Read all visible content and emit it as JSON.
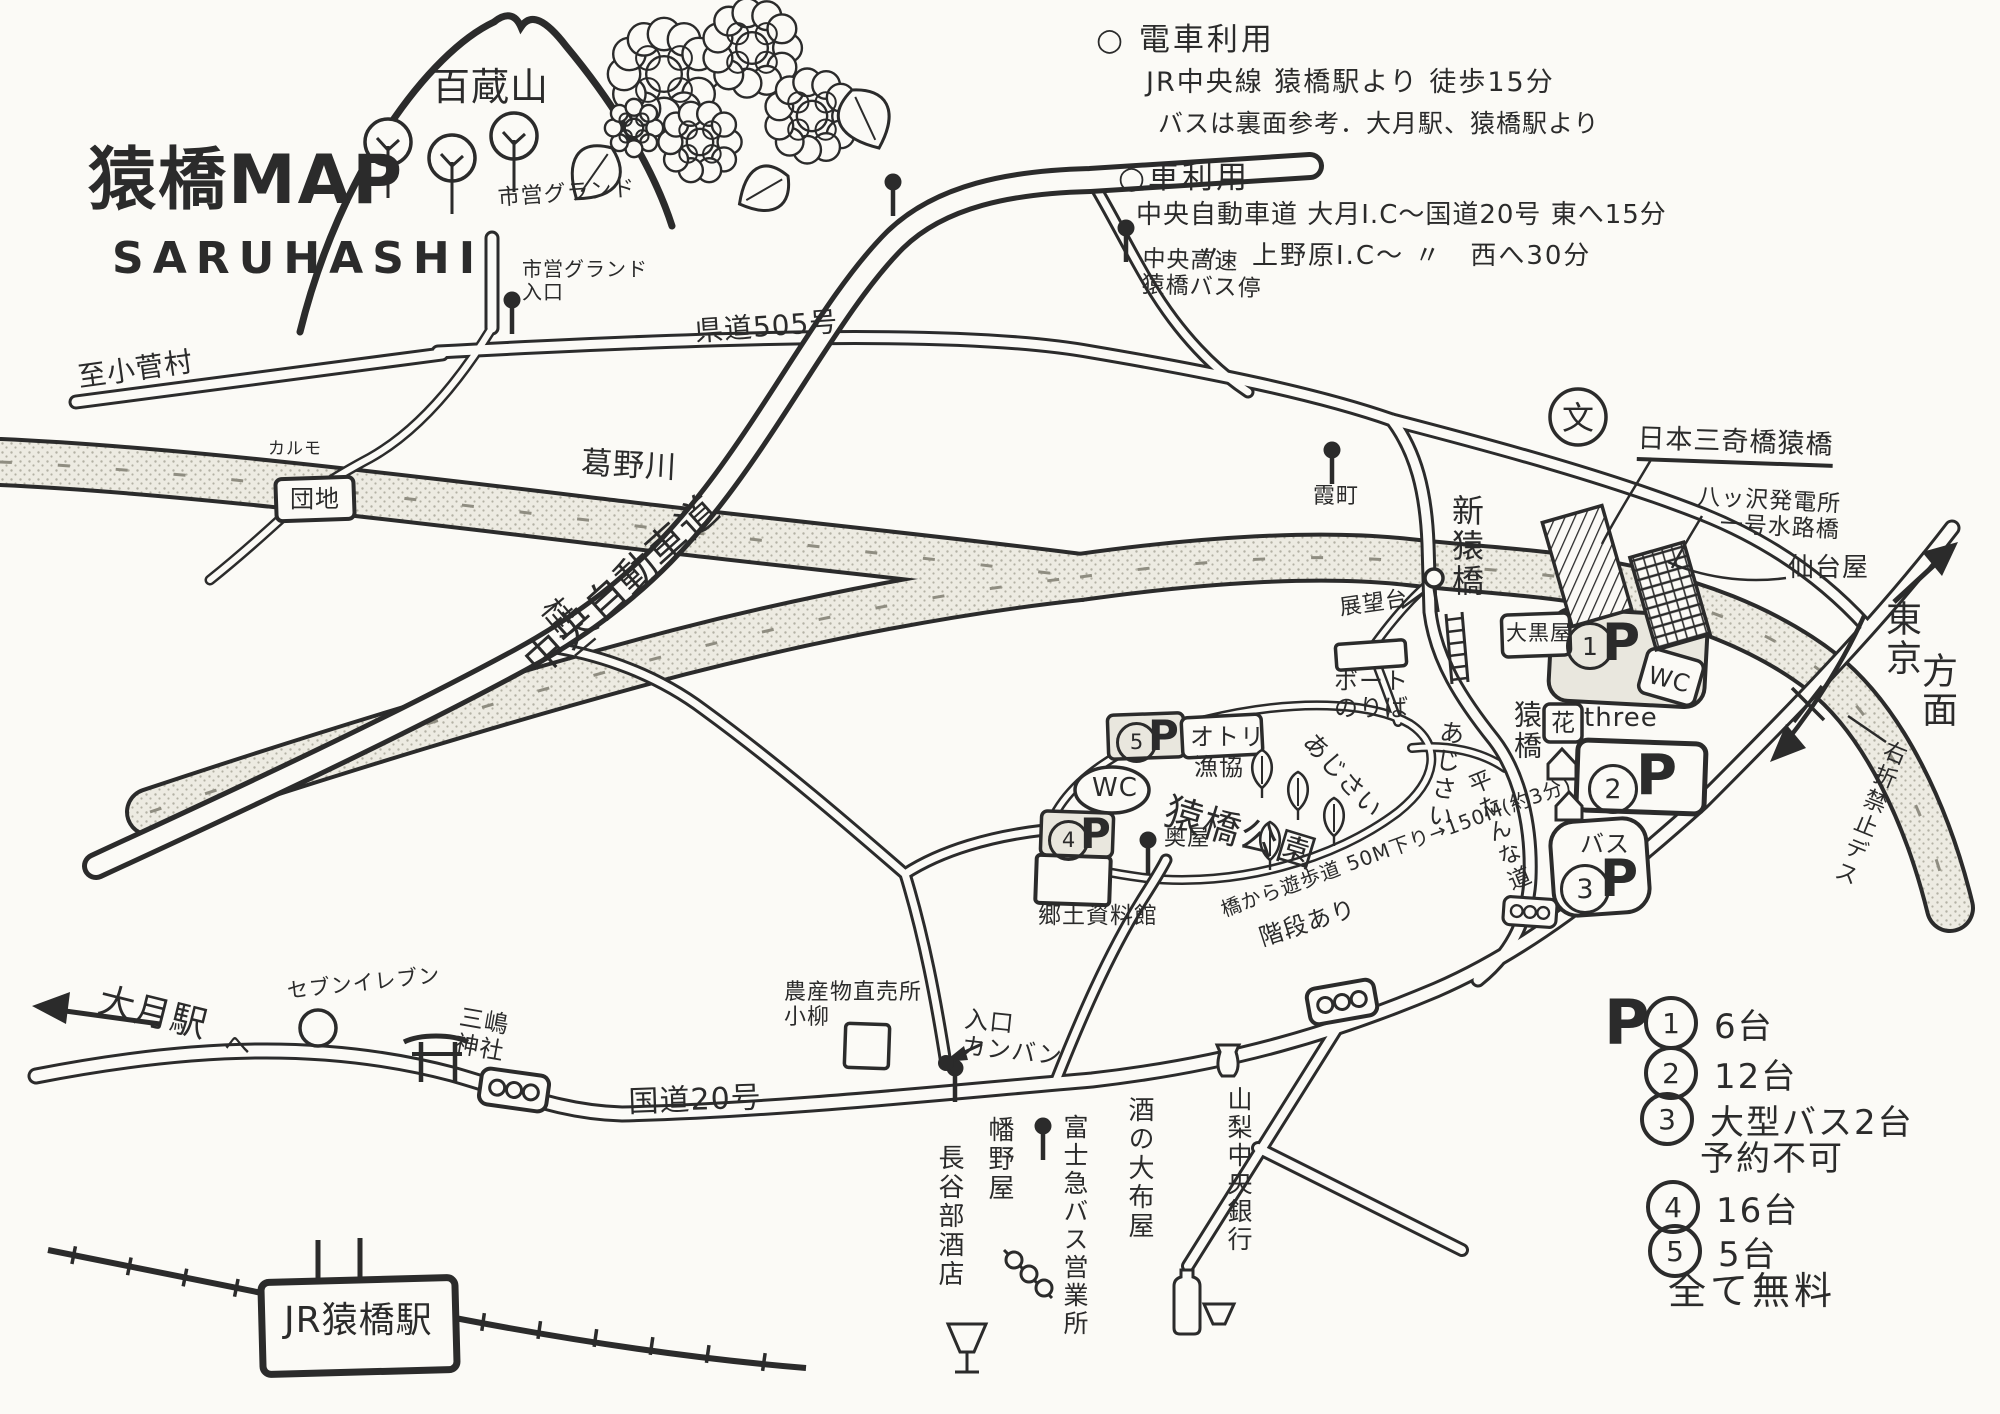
{
  "title": {
    "main": "猿橋MAP",
    "sub": "SARUHASHI"
  },
  "notes": {
    "train_title": "○ 電車利用",
    "train_line1": "JR中央線 猿橋駅より 徒歩15分",
    "train_line2": "バスは裏面参考．大月駅、猿橋駅より",
    "car_title": "○車利用",
    "car_line1": "中央自動車道 大月I.C〜国道20号 東へ15分",
    "car_line2": "〃　上野原I.C〜 〃　西へ30分"
  },
  "legend": {
    "symbol": "P",
    "items": [
      {
        "num": "1",
        "text": "6台"
      },
      {
        "num": "2",
        "text": "12台"
      },
      {
        "num": "3",
        "text": "大型バス2台",
        "note": "予約不可"
      },
      {
        "num": "4",
        "text": "16台"
      },
      {
        "num": "5",
        "text": "5台"
      }
    ],
    "footer": "全て無料"
  },
  "map_labels": [
    {
      "id": "mt-momokura",
      "text": "百蔵山",
      "x": 432,
      "y": 66,
      "size": 38
    },
    {
      "id": "shiei-ground",
      "text": "市営グランド",
      "x": 497,
      "y": 186,
      "size": 22,
      "rot": -4
    },
    {
      "id": "shiei-ground-entrance",
      "text": "市営グランド\n入口",
      "x": 522,
      "y": 258,
      "size": 20
    },
    {
      "id": "chuo-kosoku-bus-stop",
      "text": "中央高速\n猿橋バス停",
      "x": 1143,
      "y": 246,
      "size": 23,
      "rot": 2
    },
    {
      "id": "kendo-505",
      "text": "県道505号",
      "x": 694,
      "y": 316,
      "size": 28,
      "rot": -4
    },
    {
      "id": "to-kosuge-mura",
      "text": "至小菅村",
      "x": 76,
      "y": 362,
      "size": 28,
      "rot": -8
    },
    {
      "id": "karumo",
      "text": "カルモ",
      "x": 268,
      "y": 440,
      "size": 17
    },
    {
      "id": "danchi",
      "text": "団地",
      "x": 290,
      "y": 486,
      "size": 24
    },
    {
      "id": "chuo-expressway",
      "text": "中央自動車道",
      "x": 516,
      "y": 652,
      "size": 40,
      "rot": -42
    },
    {
      "id": "katsuno-river",
      "text": "葛野川",
      "x": 582,
      "y": 446,
      "size": 31,
      "rot": 3
    },
    {
      "id": "katsura-river",
      "text": "桂川",
      "x": 560,
      "y": 592,
      "size": 31,
      "rot": 50
    },
    {
      "id": "kasumi-cho",
      "text": "霞町",
      "x": 1313,
      "y": 484,
      "size": 22
    },
    {
      "id": "shin-saruhashi",
      "text": "新猿橋",
      "x": 1450,
      "y": 494,
      "size": 32,
      "vertical": true
    },
    {
      "id": "school-mark",
      "text": "文",
      "x": 1562,
      "y": 400,
      "size": 32
    },
    {
      "id": "nihon-sankyo-saruhashi",
      "text": "日本三奇橋猿橋",
      "x": 1638,
      "y": 424,
      "size": 27,
      "rot": 2,
      "underline": true
    },
    {
      "id": "yatsuzawa-power",
      "text": "八ッ沢発電所\n　一号水路橋",
      "x": 1698,
      "y": 484,
      "size": 23,
      "rot": 3
    },
    {
      "id": "sendai-ya",
      "text": "仙台屋",
      "x": 1788,
      "y": 554,
      "size": 26
    },
    {
      "id": "tokyo",
      "text": "東京",
      "x": 1882,
      "y": 600,
      "size": 36,
      "vertical": true
    },
    {
      "id": "homen",
      "text": "方面",
      "x": 1918,
      "y": 652,
      "size": 36,
      "vertical": true
    },
    {
      "id": "no-right-turn",
      "text": "右折禁止デス",
      "x": 1886,
      "y": 736,
      "size": 23,
      "vertical": true,
      "rot": 22
    },
    {
      "id": "tenbodai",
      "text": "展望台",
      "x": 1338,
      "y": 596,
      "size": 22,
      "rot": -8
    },
    {
      "id": "boat-noriba",
      "text": "ボート\nのりば",
      "x": 1334,
      "y": 668,
      "size": 24
    },
    {
      "id": "otori",
      "text": "オトリ",
      "x": 1190,
      "y": 724,
      "size": 24
    },
    {
      "id": "gyokyo",
      "text": "漁協",
      "x": 1194,
      "y": 754,
      "size": 24
    },
    {
      "id": "wc-park",
      "text": "WC",
      "x": 1092,
      "y": 774,
      "size": 26
    },
    {
      "id": "saruhashi-park",
      "text": "猿橋公園",
      "x": 1172,
      "y": 790,
      "size": 38,
      "rot": 17
    },
    {
      "id": "ajisai-1",
      "text": "あじさい",
      "x": 1318,
      "y": 728,
      "size": 25,
      "rot": 48
    },
    {
      "id": "ajisai-2",
      "text": "あじさい",
      "x": 1440,
      "y": 718,
      "size": 25,
      "vertical": true,
      "rot": 8
    },
    {
      "id": "flat-road",
      "text": "平たんな道",
      "x": 1462,
      "y": 776,
      "size": 23,
      "vertical": true,
      "rot": -22
    },
    {
      "id": "promenade-note",
      "text": "橋から遊歩道 50M下り→150M(約3分)",
      "x": 1218,
      "y": 900,
      "size": 20,
      "rot": -20
    },
    {
      "id": "stairs-note",
      "text": "階段あり",
      "x": 1256,
      "y": 926,
      "size": 24,
      "rot": -18
    },
    {
      "id": "kyodo-museum",
      "text": "郷土資料館",
      "x": 1038,
      "y": 903,
      "size": 23
    },
    {
      "id": "saruhashi-bridge",
      "text": "猿橋",
      "x": 1512,
      "y": 700,
      "size": 28,
      "vertical": true
    },
    {
      "id": "hana",
      "text": "花",
      "x": 1551,
      "y": 710,
      "size": 24
    },
    {
      "id": "three",
      "text": "three",
      "x": 1584,
      "y": 704,
      "size": 26
    },
    {
      "id": "daikoku-ya",
      "text": "大黒屋",
      "x": 1506,
      "y": 622,
      "size": 21
    },
    {
      "id": "p1-num",
      "circle": true,
      "text": "1",
      "x": 1566,
      "y": 622,
      "size": 32
    },
    {
      "id": "p1-p",
      "text": "P",
      "x": 1602,
      "y": 614,
      "size": 52,
      "bold": true
    },
    {
      "id": "wc-east",
      "text": "WC",
      "x": 1652,
      "y": 662,
      "size": 24,
      "rot": 14
    },
    {
      "id": "p2-num",
      "circle": true,
      "text": "2",
      "x": 1588,
      "y": 764,
      "size": 34
    },
    {
      "id": "p2-p",
      "text": "P",
      "x": 1636,
      "y": 744,
      "size": 56,
      "bold": true
    },
    {
      "id": "bus-p3",
      "text": "バス",
      "x": 1580,
      "y": 831,
      "size": 24
    },
    {
      "id": "p3-num",
      "circle": true,
      "text": "3",
      "x": 1560,
      "y": 864,
      "size": 34
    },
    {
      "id": "p3-p",
      "text": "P",
      "x": 1600,
      "y": 850,
      "size": 52,
      "bold": true
    },
    {
      "id": "p4-num",
      "circle": true,
      "text": "4",
      "x": 1048,
      "y": 820,
      "size": 27
    },
    {
      "id": "p4-p",
      "text": "P",
      "x": 1080,
      "y": 810,
      "size": 42,
      "bold": true
    },
    {
      "id": "p5-num",
      "circle": true,
      "text": "5",
      "x": 1116,
      "y": 722,
      "size": 27
    },
    {
      "id": "p5-p",
      "text": "P",
      "x": 1148,
      "y": 712,
      "size": 42,
      "bold": true
    },
    {
      "id": "oku-ya",
      "text": "奥屋",
      "x": 1164,
      "y": 826,
      "size": 22
    },
    {
      "id": "to-otsuki-station",
      "text": "大月駅",
      "x": 104,
      "y": 980,
      "size": 36,
      "rot": 14
    },
    {
      "id": "to-otsuki-he",
      "text": "へ",
      "x": 224,
      "y": 1032,
      "size": 26
    },
    {
      "id": "seven-eleven",
      "text": "セブンイレブン",
      "x": 286,
      "y": 980,
      "size": 21,
      "rot": -6
    },
    {
      "id": "mishima-shrine",
      "text": "三嶋\n神社",
      "x": 462,
      "y": 1004,
      "size": 24,
      "rot": 10
    },
    {
      "id": "route-20",
      "text": "国道20号",
      "x": 628,
      "y": 1086,
      "size": 30,
      "rot": -2
    },
    {
      "id": "farm-stand",
      "text": "農産物直売所\n小柳",
      "x": 784,
      "y": 980,
      "size": 22
    },
    {
      "id": "entrance-signboard",
      "text": "入口\nカンバン",
      "x": 966,
      "y": 1006,
      "size": 24,
      "rot": 6
    },
    {
      "id": "hatano-ya",
      "text": "幡野屋",
      "x": 986,
      "y": 1116,
      "size": 26,
      "vertical": true
    },
    {
      "id": "hasebe-saketen",
      "text": "長谷部酒店",
      "x": 936,
      "y": 1144,
      "size": 26,
      "vertical": true
    },
    {
      "id": "fujikyu-bus-office",
      "text": "富士急バス営業所",
      "x": 1062,
      "y": 1114,
      "size": 25,
      "vertical": true
    },
    {
      "id": "sake-no-ofuya",
      "text": "酒の大布屋",
      "x": 1126,
      "y": 1096,
      "size": 26,
      "vertical": true
    },
    {
      "id": "yamanashi-chuo-bank",
      "text": "山梨中央銀行",
      "x": 1226,
      "y": 1086,
      "size": 25,
      "vertical": true
    },
    {
      "id": "jr-saruhashi-station",
      "text": "JR猿橋駅",
      "x": 284,
      "y": 1300,
      "size": 36
    }
  ]
}
